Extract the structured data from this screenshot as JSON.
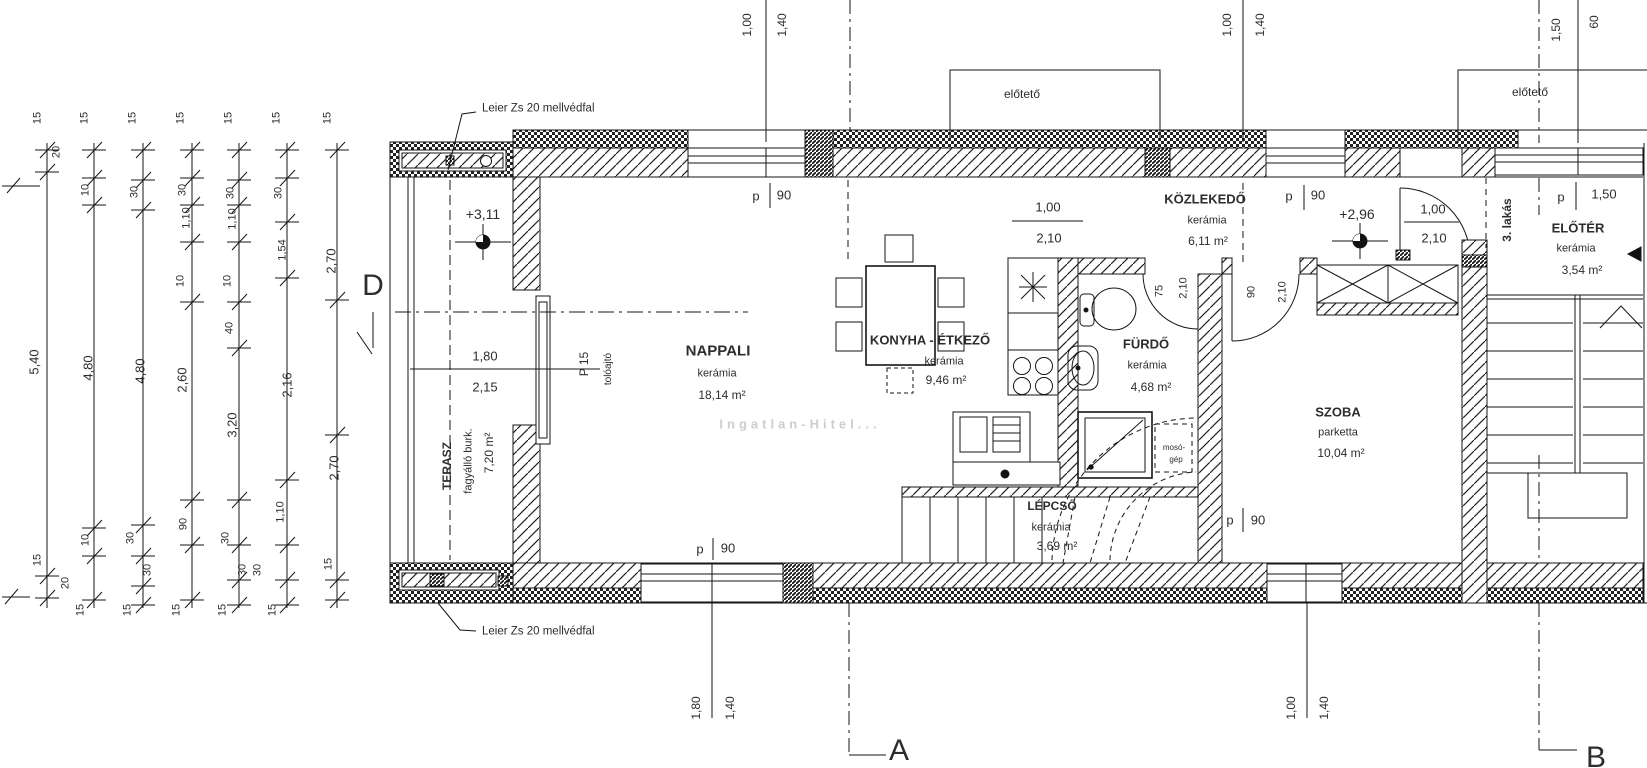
{
  "drawing": {
    "title": "3. lakás emeleti alaprajz",
    "watermark": "Ingatlan-Hitel...",
    "annotations": {
      "parapet_note_top": "Leier Zs 20 mellvédfal",
      "parapet_note_bottom": "Leier Zs 20 mellvédfal",
      "canopy_left": "előtető",
      "canopy_right": "előtető",
      "apartment_label": "3. lakás",
      "sliding_door": "tolóajtó",
      "sliding_door_type": "P 15",
      "washer_line1": "mosó-",
      "washer_line2": "gép"
    },
    "rooms": [
      {
        "key": "nappali",
        "name": "NAPPALI",
        "finish": "kerámia",
        "area": "18,14 m²",
        "rot": 0,
        "size": 15,
        "pos": {
          "name": [
            718,
            351
          ],
          "finish": [
            717,
            374
          ],
          "area": [
            722,
            395
          ]
        }
      },
      {
        "key": "terasz",
        "name": "TERASZ",
        "finish": "fagyálló burk.",
        "area": "7,20 m²",
        "rot": 1,
        "size": 12,
        "pos": {
          "name": [
            447,
            466
          ],
          "finish": [
            469,
            461
          ],
          "area": [
            489,
            453
          ]
        }
      },
      {
        "key": "konyha-etkezo",
        "name": "KONYHA - ÉTKEZŐ",
        "finish": "kerámia",
        "area": "9,46 m²",
        "rot": 0,
        "size": 13,
        "pos": {
          "name": [
            930,
            340
          ],
          "finish": [
            944,
            362
          ],
          "area": [
            946,
            380
          ]
        }
      },
      {
        "key": "furdo",
        "name": "FÜRDŐ",
        "finish": "kerámia",
        "area": "4,68 m²",
        "rot": 0,
        "size": 13,
        "pos": {
          "name": [
            1146,
            344
          ],
          "finish": [
            1147,
            366
          ],
          "area": [
            1151,
            387
          ]
        }
      },
      {
        "key": "kozlekedo",
        "name": "KÖZLEKEDŐ",
        "finish": "kerámia",
        "area": "6,11 m²",
        "rot": 0,
        "size": 13,
        "pos": {
          "name": [
            1205,
            199
          ],
          "finish": [
            1207,
            221
          ],
          "area": [
            1208,
            241
          ]
        }
      },
      {
        "key": "szoba",
        "name": "SZOBA",
        "finish": "parketta",
        "area": "10,04 m²",
        "rot": 0,
        "size": 13,
        "pos": {
          "name": [
            1338,
            412
          ],
          "finish": [
            1338,
            433
          ],
          "area": [
            1341,
            453
          ]
        }
      },
      {
        "key": "eloter",
        "name": "ELŐTÉR",
        "finish": "kerámia",
        "area": "3,54 m²",
        "rot": 0,
        "size": 13,
        "pos": {
          "name": [
            1578,
            228
          ],
          "finish": [
            1576,
            249
          ],
          "area": [
            1582,
            270
          ]
        }
      },
      {
        "key": "lepcso",
        "name": "LÉPCSŐ",
        "finish": "kerámia",
        "area": "3,69 m²",
        "rot": 0,
        "size": 12,
        "pos": {
          "name": [
            1052,
            506
          ],
          "finish": [
            1051,
            528
          ],
          "area": [
            1057,
            546
          ]
        }
      }
    ],
    "labels": [
      {
        "t": "1,00",
        "x": 747,
        "y": 25,
        "r": 1,
        "s": 12,
        "n": "dim-top-left-a"
      },
      {
        "t": "1,40",
        "x": 782,
        "y": 25,
        "r": 1,
        "s": 12,
        "n": "dim-top-left-b"
      },
      {
        "t": "1,00",
        "x": 1227,
        "y": 25,
        "r": 1,
        "s": 12,
        "n": "dim-top-mid-a"
      },
      {
        "t": "1,40",
        "x": 1260,
        "y": 25,
        "r": 1,
        "s": 12,
        "n": "dim-top-mid-b"
      },
      {
        "t": "1,50",
        "x": 1556,
        "y": 30,
        "r": 1,
        "s": 12,
        "n": "dim-top-right-a"
      },
      {
        "t": "60",
        "x": 1594,
        "y": 22,
        "r": 1,
        "s": 12,
        "n": "dim-top-right-b"
      },
      {
        "t": "1,80",
        "x": 696,
        "y": 708,
        "r": 1,
        "s": 12,
        "n": "dim-bottom-left-a"
      },
      {
        "t": "1,40",
        "x": 730,
        "y": 708,
        "r": 1,
        "s": 12,
        "n": "dim-bottom-left-b"
      },
      {
        "t": "1,00",
        "x": 1291,
        "y": 708,
        "r": 1,
        "s": 12,
        "n": "dim-bottom-right-a"
      },
      {
        "t": "1,40",
        "x": 1324,
        "y": 708,
        "r": 1,
        "s": 12,
        "n": "dim-bottom-right-b"
      },
      {
        "t": "p",
        "x": 756,
        "y": 196,
        "s": 13,
        "n": "window-parapet-p"
      },
      {
        "t": "90",
        "x": 784,
        "y": 195,
        "s": 13,
        "n": "window-parapet-value"
      },
      {
        "t": "p",
        "x": 1289,
        "y": 196,
        "s": 13,
        "n": "window-parapet-p"
      },
      {
        "t": "90",
        "x": 1318,
        "y": 195,
        "s": 13,
        "n": "window-parapet-value"
      },
      {
        "t": "p",
        "x": 1561,
        "y": 197,
        "s": 13,
        "n": "window-parapet-p"
      },
      {
        "t": "1,50",
        "x": 1604,
        "y": 194,
        "s": 13,
        "n": "window-parapet-value"
      },
      {
        "t": "p",
        "x": 700,
        "y": 549,
        "s": 13,
        "n": "window-parapet-p"
      },
      {
        "t": "90",
        "x": 728,
        "y": 548,
        "s": 13,
        "n": "window-parapet-value"
      },
      {
        "t": "p",
        "x": 1230,
        "y": 520,
        "s": 13,
        "n": "window-parapet-p"
      },
      {
        "t": "90",
        "x": 1258,
        "y": 520,
        "s": 13,
        "n": "window-parapet-value"
      },
      {
        "t": "1,00",
        "x": 1048,
        "y": 207,
        "s": 13,
        "n": "opening-width"
      },
      {
        "t": "2,10",
        "x": 1049,
        "y": 238,
        "s": 13,
        "n": "opening-height"
      },
      {
        "t": "1,00",
        "x": 1433,
        "y": 209,
        "s": 13,
        "n": "door-width"
      },
      {
        "t": "2,10",
        "x": 1434,
        "y": 238,
        "s": 13,
        "n": "door-height"
      },
      {
        "t": "1,80",
        "x": 485,
        "y": 356,
        "s": 13,
        "n": "opening-width"
      },
      {
        "t": "2,15",
        "x": 485,
        "y": 387,
        "s": 13,
        "n": "opening-height"
      },
      {
        "t": "75",
        "x": 1160,
        "y": 291,
        "r": 1,
        "s": 11,
        "n": "door-width"
      },
      {
        "t": "2,10",
        "x": 1184,
        "y": 288,
        "r": 1,
        "s": 11,
        "n": "door-height"
      },
      {
        "t": "90",
        "x": 1252,
        "y": 292,
        "r": 1,
        "s": 11,
        "n": "door-width"
      },
      {
        "t": "2,10",
        "x": 1283,
        "y": 292,
        "r": 1,
        "s": 11,
        "n": "door-height"
      },
      {
        "t": "+3,11",
        "x": 483,
        "y": 214,
        "s": 14,
        "n": "level-marker-value"
      },
      {
        "t": "+2,96",
        "x": 1357,
        "y": 214,
        "s": 14,
        "n": "level-marker-value"
      },
      {
        "t": "D",
        "x": 373,
        "y": 286,
        "s": 30,
        "n": "section-marker-d"
      },
      {
        "t": "A",
        "x": 899,
        "y": 751,
        "s": 30,
        "n": "section-marker-a"
      },
      {
        "t": "B",
        "x": 1596,
        "y": 758,
        "s": 30,
        "n": "section-marker-b"
      },
      {
        "t": "P 15",
        "x": 584,
        "y": 364,
        "r": 1,
        "s": 12,
        "n": "sliding-door-type"
      },
      {
        "t": "tolóajtó",
        "x": 609,
        "y": 369,
        "r": 1,
        "s": 10,
        "n": "sliding-door-label"
      },
      {
        "t": "3. lakás",
        "x": 1507,
        "y": 220,
        "r": 1,
        "s": 12,
        "b": 1,
        "n": "apartment-label"
      },
      {
        "t": "mosó-",
        "x": 1174,
        "y": 448,
        "s": 8,
        "n": "washer-label"
      },
      {
        "t": "gép",
        "x": 1176,
        "y": 460,
        "s": 8,
        "n": "washer-label"
      },
      {
        "t": "15",
        "x": 38,
        "y": 118,
        "r": 1,
        "n": "dim-chain"
      },
      {
        "t": "20",
        "x": 57,
        "y": 152,
        "r": 1,
        "n": "dim-chain"
      },
      {
        "t": "5,40",
        "x": 34,
        "y": 362,
        "r": 1,
        "s": 13,
        "n": "dim-chain"
      },
      {
        "t": "15",
        "x": 38,
        "y": 560,
        "r": 1,
        "n": "dim-chain"
      },
      {
        "t": "20",
        "x": 66,
        "y": 583,
        "r": 1,
        "n": "dim-chain"
      },
      {
        "t": "15",
        "x": 85,
        "y": 118,
        "r": 1,
        "n": "dim-chain"
      },
      {
        "t": "10",
        "x": 86,
        "y": 190,
        "r": 1,
        "n": "dim-chain"
      },
      {
        "t": "4,80",
        "x": 88,
        "y": 368,
        "r": 1,
        "s": 13,
        "n": "dim-chain"
      },
      {
        "t": "10",
        "x": 86,
        "y": 540,
        "r": 1,
        "n": "dim-chain"
      },
      {
        "t": "15",
        "x": 81,
        "y": 610,
        "r": 1,
        "n": "dim-chain"
      },
      {
        "t": "15",
        "x": 133,
        "y": 118,
        "r": 1,
        "n": "dim-chain"
      },
      {
        "t": "30",
        "x": 135,
        "y": 192,
        "r": 1,
        "n": "dim-chain"
      },
      {
        "t": "4,80",
        "x": 140,
        "y": 371,
        "r": 1,
        "s": 13,
        "n": "dim-chain"
      },
      {
        "t": "30",
        "x": 131,
        "y": 538,
        "r": 1,
        "n": "dim-chain"
      },
      {
        "t": "30",
        "x": 148,
        "y": 570,
        "r": 1,
        "n": "dim-chain"
      },
      {
        "t": "15",
        "x": 128,
        "y": 610,
        "r": 1,
        "n": "dim-chain"
      },
      {
        "t": "15",
        "x": 181,
        "y": 118,
        "r": 1,
        "n": "dim-chain"
      },
      {
        "t": "30",
        "x": 183,
        "y": 190,
        "r": 1,
        "n": "dim-chain"
      },
      {
        "t": "1,10",
        "x": 187,
        "y": 218,
        "r": 1,
        "n": "dim-chain"
      },
      {
        "t": "10",
        "x": 181,
        "y": 281,
        "r": 1,
        "n": "dim-chain"
      },
      {
        "t": "2,60",
        "x": 182,
        "y": 380,
        "r": 1,
        "s": 13,
        "n": "dim-chain"
      },
      {
        "t": "90",
        "x": 184,
        "y": 524,
        "r": 1,
        "n": "dim-chain"
      },
      {
        "t": "15",
        "x": 177,
        "y": 610,
        "r": 1,
        "n": "dim-chain"
      },
      {
        "t": "15",
        "x": 229,
        "y": 118,
        "r": 1,
        "n": "dim-chain"
      },
      {
        "t": "30",
        "x": 231,
        "y": 193,
        "r": 1,
        "n": "dim-chain"
      },
      {
        "t": "1,10",
        "x": 233,
        "y": 219,
        "r": 1,
        "n": "dim-chain"
      },
      {
        "t": "10",
        "x": 228,
        "y": 281,
        "r": 1,
        "n": "dim-chain"
      },
      {
        "t": "40",
        "x": 230,
        "y": 328,
        "r": 1,
        "n": "dim-chain"
      },
      {
        "t": "3,20",
        "x": 232,
        "y": 425,
        "r": 1,
        "s": 13,
        "n": "dim-chain"
      },
      {
        "t": "30",
        "x": 226,
        "y": 538,
        "r": 1,
        "n": "dim-chain"
      },
      {
        "t": "30",
        "x": 243,
        "y": 570,
        "r": 1,
        "n": "dim-chain"
      },
      {
        "t": "15",
        "x": 223,
        "y": 610,
        "r": 1,
        "n": "dim-chain"
      },
      {
        "t": "15",
        "x": 277,
        "y": 118,
        "r": 1,
        "n": "dim-chain"
      },
      {
        "t": "30",
        "x": 279,
        "y": 193,
        "r": 1,
        "n": "dim-chain"
      },
      {
        "t": "1,54",
        "x": 283,
        "y": 250,
        "r": 1,
        "n": "dim-chain"
      },
      {
        "t": "2,16",
        "x": 287,
        "y": 385,
        "r": 1,
        "s": 13,
        "n": "dim-chain"
      },
      {
        "t": "1,10",
        "x": 281,
        "y": 512,
        "r": 1,
        "n": "dim-chain"
      },
      {
        "t": "30",
        "x": 258,
        "y": 570,
        "r": 1,
        "n": "dim-chain"
      },
      {
        "t": "15",
        "x": 273,
        "y": 610,
        "r": 1,
        "n": "dim-chain"
      },
      {
        "t": "15",
        "x": 328,
        "y": 118,
        "r": 1,
        "n": "dim-chain"
      },
      {
        "t": "2,70",
        "x": 331,
        "y": 261,
        "r": 1,
        "s": 13,
        "n": "dim-chain"
      },
      {
        "t": "2,70",
        "x": 334,
        "y": 468,
        "r": 1,
        "s": 13,
        "n": "dim-chain"
      },
      {
        "t": "15",
        "x": 329,
        "y": 564,
        "r": 1,
        "n": "dim-chain"
      }
    ]
  }
}
